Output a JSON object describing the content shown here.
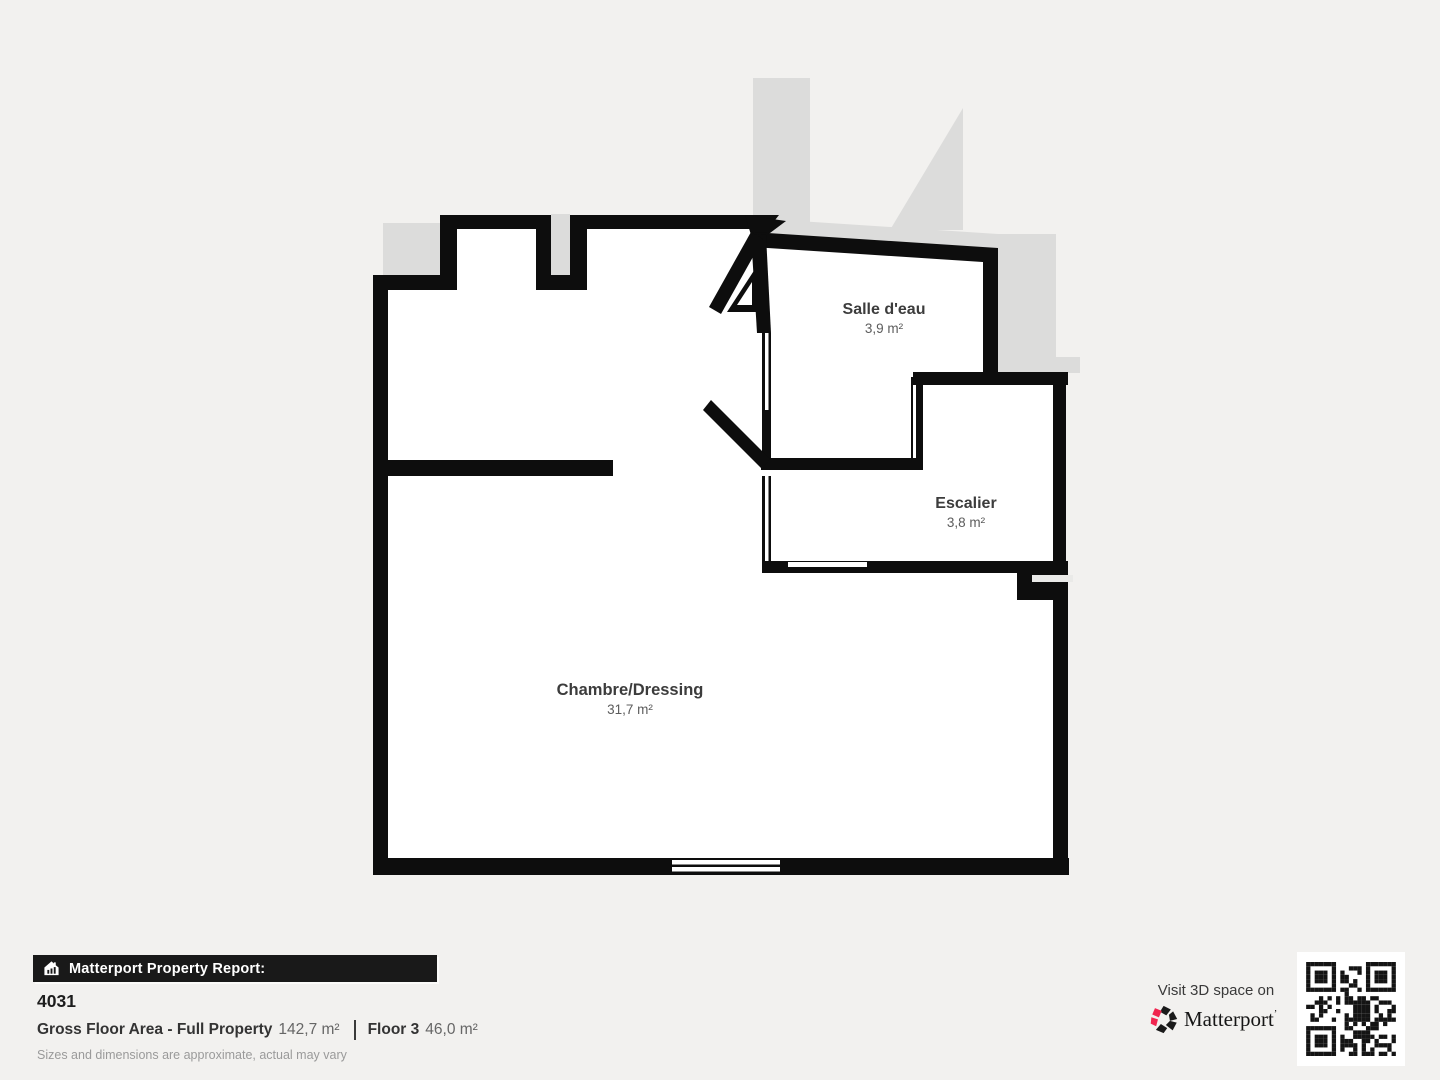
{
  "colors": {
    "page_background": "#f2f1ef",
    "wall": "#0d0d0d",
    "floor": "#ffffff",
    "adjacent_area_gray": "#dcdcdb",
    "banner_background": "#191919",
    "brand_red": "#f0254f"
  },
  "floor_plan": {
    "rooms": [
      {
        "name": "Salle d'eau",
        "area": "3,9 m²"
      },
      {
        "name": "Escalier",
        "area": "3,8 m²"
      },
      {
        "name": "Chambre/Dressing",
        "area": "31,7 m²"
      }
    ]
  },
  "footer": {
    "report_banner": "Matterport Property Report:",
    "property_id": "4031",
    "gross_floor_area_label": "Gross Floor Area - Full Property",
    "gross_floor_area_value": "142,7 m²",
    "floor_label": "Floor 3",
    "floor_value": "46,0 m²",
    "disclaimer": "Sizes and dimensions are approximate, actual may vary",
    "visit_text": "Visit 3D space on",
    "brand": "Matterport"
  }
}
